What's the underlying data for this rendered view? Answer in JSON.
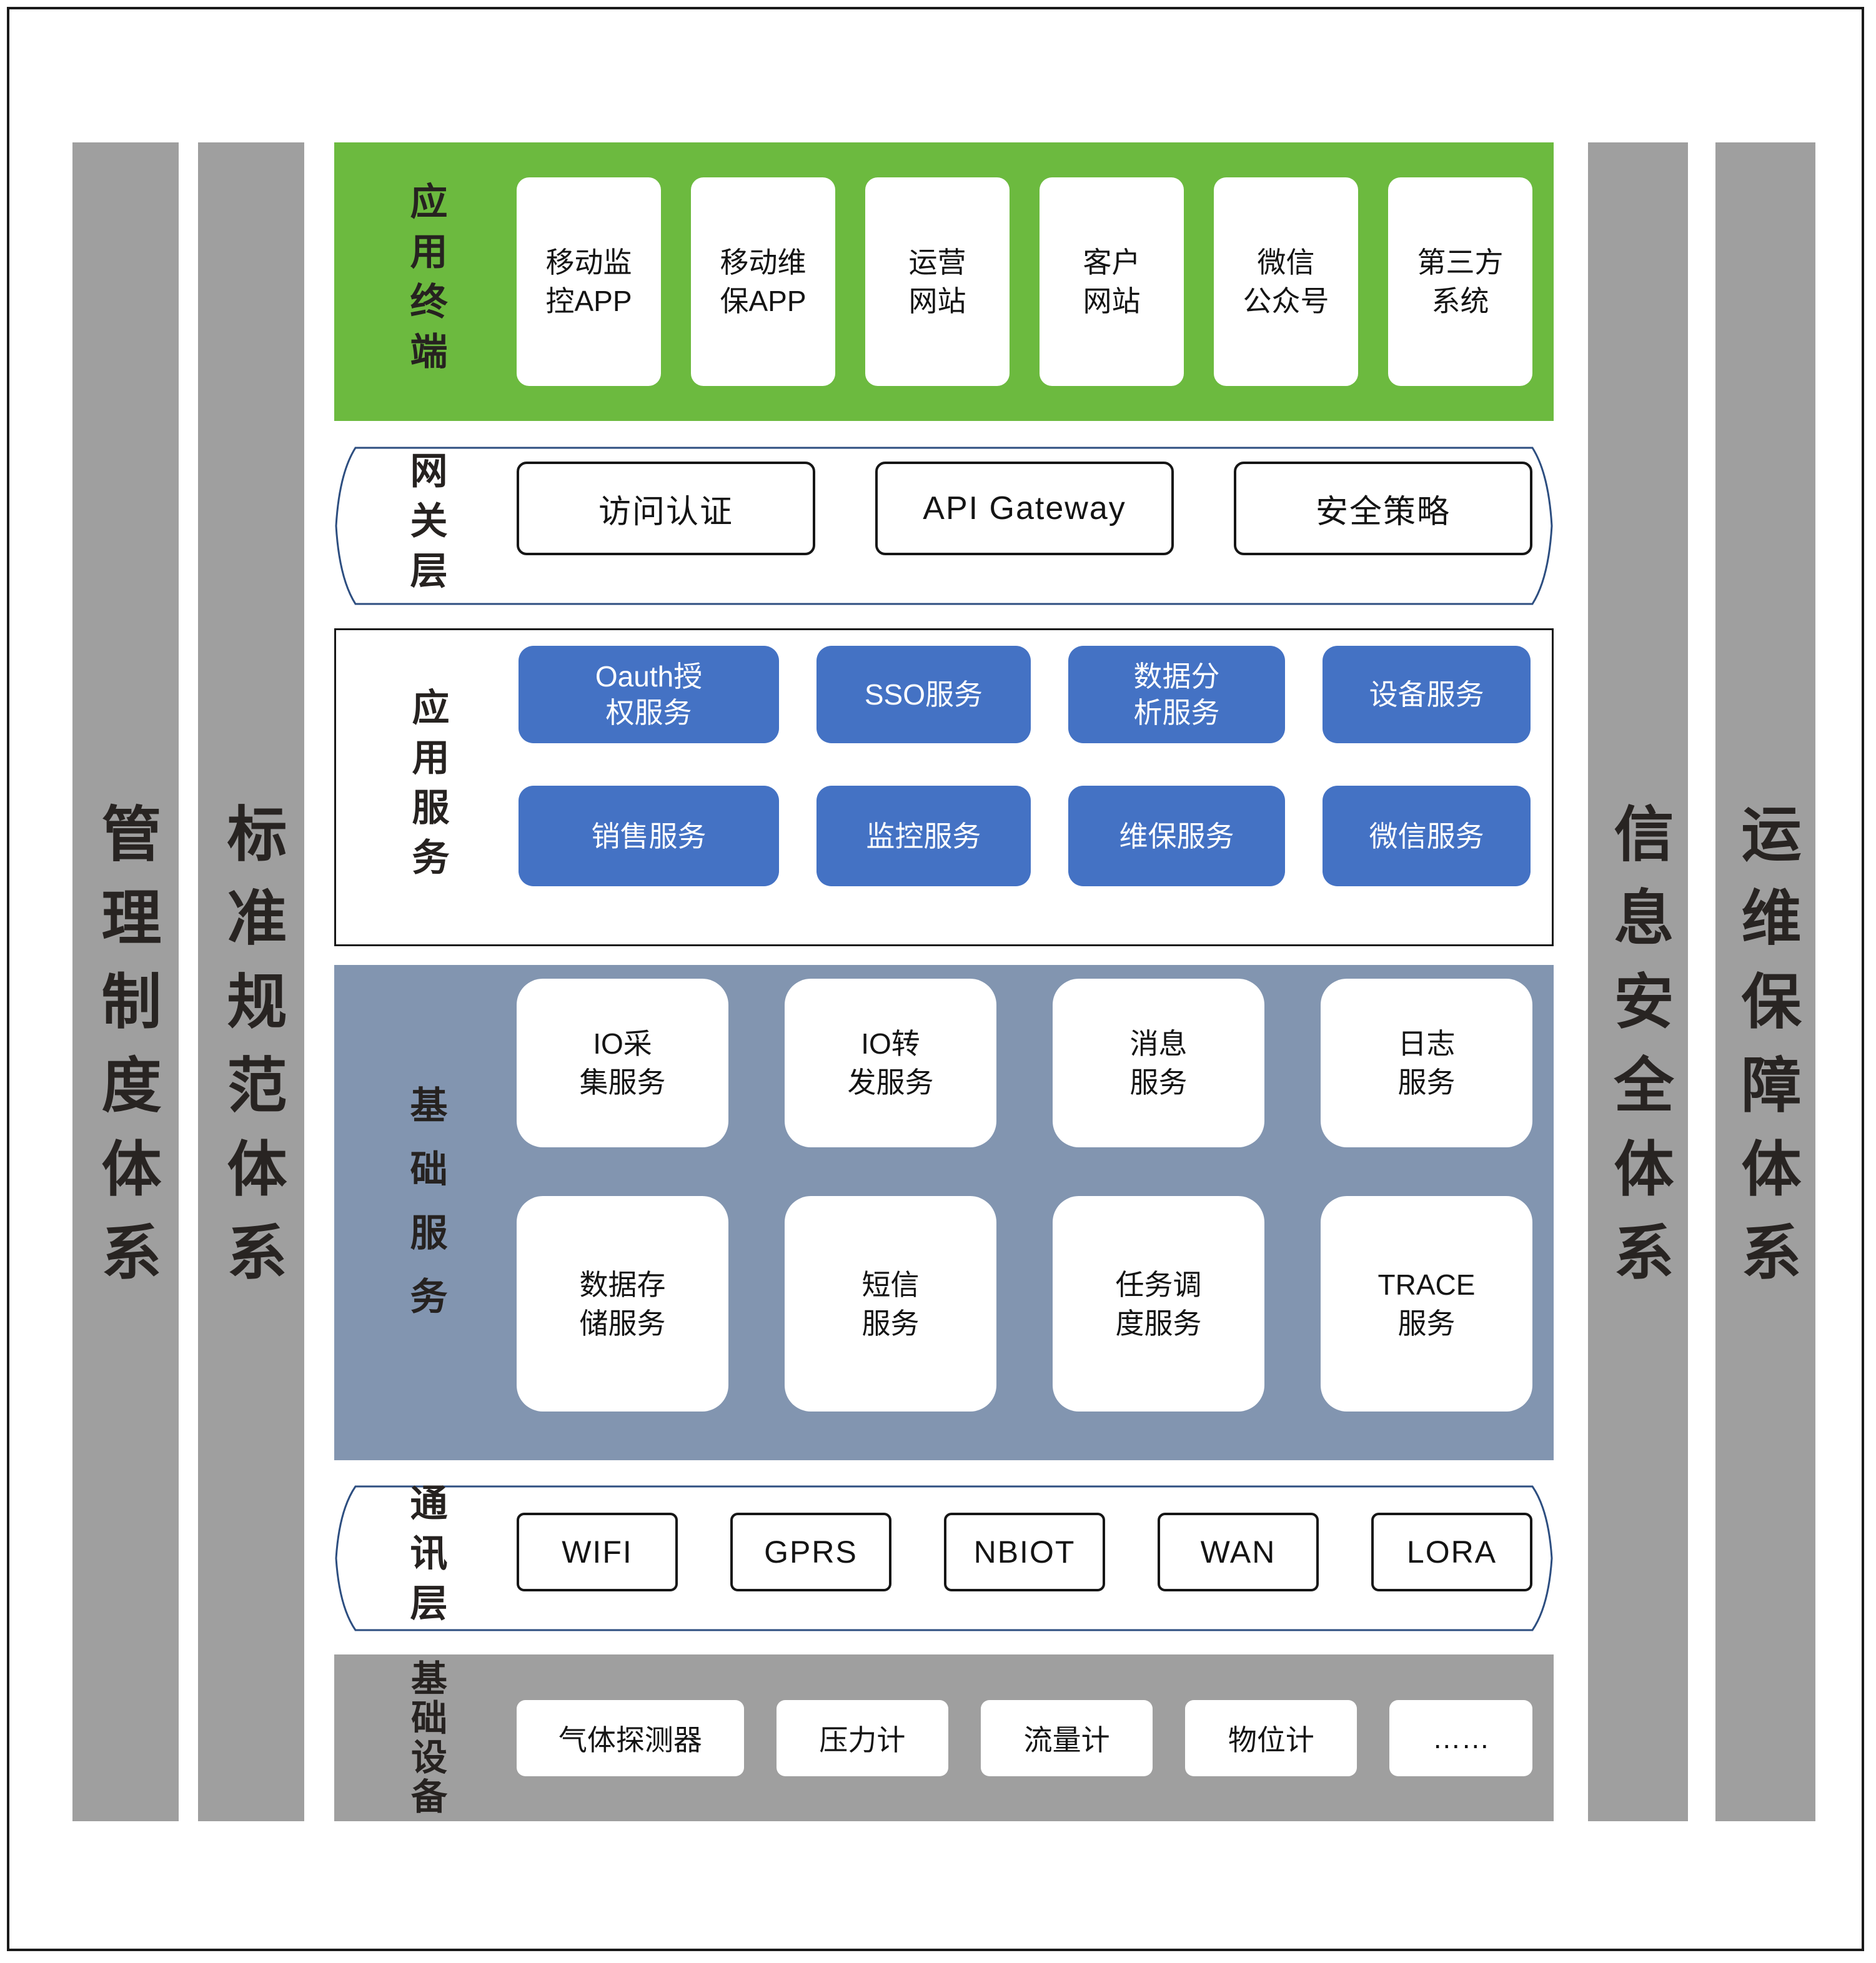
{
  "colors": {
    "terminal_layer_bg": "#6cba3f",
    "service_box_blue": "#4472c4",
    "base_layer_bluegray": "#8295b0",
    "bar_gray": "#9f9f9f",
    "hex_border_navy": "#2d4e80",
    "frame_border": "#1a1a1a"
  },
  "side_bars": {
    "management": {
      "label": "管理制度体系"
    },
    "standards": {
      "label": "标准规范体系"
    },
    "security": {
      "label": "信息安全体系"
    },
    "operations": {
      "label": "运维保障体系"
    }
  },
  "layers": {
    "terminal": {
      "label": "应用终端",
      "boxes": [
        "移动监\n控APP",
        "移动维\n保APP",
        "运营\n网站",
        "客户\n网站",
        "微信\n公众号",
        "第三方\n系统"
      ]
    },
    "gateway": {
      "label": "网关层",
      "boxes": [
        "访问认证",
        "API Gateway",
        "安全策略"
      ]
    },
    "app_services": {
      "label": "应用服务",
      "row1": [
        "Oauth授\n权服务",
        "SSO服务",
        "数据分\n析服务",
        "设备服务"
      ],
      "row2": [
        "销售服务",
        "监控服务",
        "维保服务",
        "微信服务"
      ]
    },
    "base_services": {
      "label": "基础服务",
      "row1": [
        "IO采\n集服务",
        "IO转\n发服务",
        "消息\n服务",
        "日志\n服务"
      ],
      "row2": [
        "数据存\n储服务",
        "短信\n服务",
        "任务调\n度服务",
        "TRACE\n服务"
      ]
    },
    "comm": {
      "label": "通讯层",
      "boxes": [
        "WIFI",
        "GPRS",
        "NBIOT",
        "WAN",
        "LORA"
      ]
    },
    "devices": {
      "label": "基础设备",
      "boxes": [
        "气体探测器",
        "压力计",
        "流量计",
        "物位计",
        "……"
      ]
    }
  }
}
